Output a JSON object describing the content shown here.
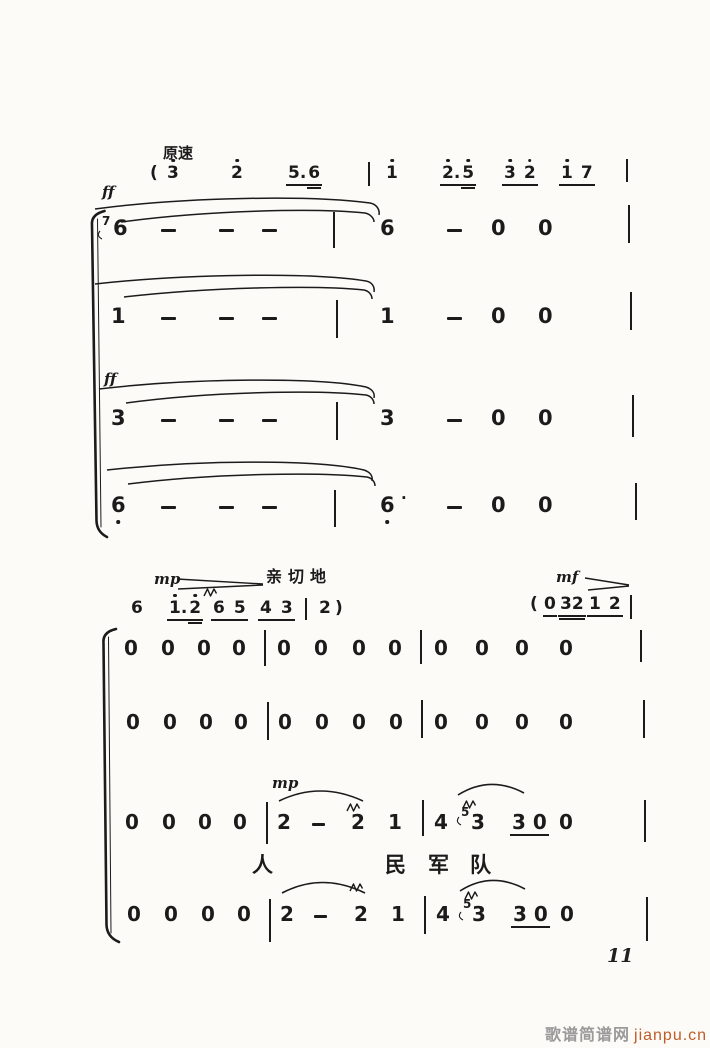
{
  "meta": {
    "ink": "#1b1b1b",
    "paper": "#fcfbf8",
    "accent": "#bf5b28",
    "watermark_gray": "#9a9a9a"
  },
  "page": {
    "number": "11"
  },
  "watermark": {
    "site_name": "歌谱简谱网",
    "site_url": "jianpu.cn"
  },
  "labels": {
    "tempo": "原速",
    "ff_voice1": "ff",
    "ff_voice3": "ff",
    "mp_cue": "mp",
    "expression": "亲切地",
    "mf_cue": "mf",
    "mp_voice": "mp"
  },
  "lines": [
    {
      "name": "cue-line-top",
      "y": 165,
      "fs": 17,
      "tokens": [
        {
          "x": 150,
          "t": "(",
          "cls": "paren",
          "name": "open-paren"
        },
        {
          "x": 167,
          "t": "3",
          "dot": "a",
          "name": "note-3"
        },
        {
          "x": 231,
          "t": "2",
          "dot": "a",
          "name": "note-2"
        },
        {
          "x": 286,
          "type": "grp",
          "gap": 2,
          "parts": [
            {
              "t": "5."
            },
            {
              "t": "6",
              "u2": true
            }
          ],
          "name": "beamed-group-5.6"
        },
        {
          "x": 368,
          "t": "|",
          "type": "bar",
          "h": 24,
          "dy": -3
        },
        {
          "x": 386,
          "t": "1",
          "dot": "a",
          "name": "note-1"
        },
        {
          "x": 440,
          "type": "grp",
          "gap": 2,
          "parts": [
            {
              "t": "2.",
              "dot": "a"
            },
            {
              "t": "5",
              "dot": "a",
              "u2": true
            }
          ],
          "name": "beamed-group-2.5"
        },
        {
          "x": 502,
          "type": "grp",
          "gap": 8,
          "parts": [
            {
              "t": "3",
              "dot": "a"
            },
            {
              "t": "2",
              "dot": "a"
            }
          ],
          "name": "beamed-group-32"
        },
        {
          "x": 559,
          "type": "grp",
          "gap": 8,
          "parts": [
            {
              "t": "1",
              "dot": "a"
            },
            {
              "t": "7"
            }
          ],
          "name": "beamed-group-17"
        },
        {
          "x": 626,
          "t": "|",
          "type": "bar",
          "h": 23,
          "dy": -6
        }
      ]
    },
    {
      "name": "voice-1",
      "y": 218,
      "fs": 21,
      "tokens": [
        {
          "x": 102,
          "t": "7",
          "type": "grace",
          "fs": 12,
          "dy": -3
        },
        {
          "x": 113,
          "t": "6",
          "name": "note-6"
        },
        {
          "x": 161,
          "t": "-",
          "type": "dash"
        },
        {
          "x": 219,
          "t": "-",
          "type": "dash"
        },
        {
          "x": 262,
          "t": "-",
          "type": "dash"
        },
        {
          "x": 333,
          "t": "|",
          "type": "bar",
          "h": 36,
          "dy": -6
        },
        {
          "x": 380,
          "t": "6",
          "name": "note-6"
        },
        {
          "x": 447,
          "t": "-",
          "type": "dash"
        },
        {
          "x": 491,
          "t": "0",
          "name": "rest-0"
        },
        {
          "x": 538,
          "t": "0",
          "name": "rest-0"
        },
        {
          "x": 628,
          "t": "|",
          "type": "bar",
          "h": 38,
          "dy": -13
        }
      ]
    },
    {
      "name": "voice-2",
      "y": 306,
      "fs": 21,
      "tokens": [
        {
          "x": 111,
          "t": "1",
          "name": "note-1"
        },
        {
          "x": 161,
          "t": "-",
          "type": "dash"
        },
        {
          "x": 219,
          "t": "-",
          "type": "dash"
        },
        {
          "x": 262,
          "t": "-",
          "type": "dash"
        },
        {
          "x": 336,
          "t": "|",
          "type": "bar",
          "h": 38,
          "dy": -6
        },
        {
          "x": 380,
          "t": "1",
          "name": "note-1"
        },
        {
          "x": 447,
          "t": "-",
          "type": "dash"
        },
        {
          "x": 491,
          "t": "0",
          "name": "rest-0"
        },
        {
          "x": 538,
          "t": "0",
          "name": "rest-0"
        },
        {
          "x": 630,
          "t": "|",
          "type": "bar",
          "h": 38,
          "dy": -14
        }
      ]
    },
    {
      "name": "voice-3",
      "y": 408,
      "fs": 21,
      "tokens": [
        {
          "x": 111,
          "t": "3",
          "name": "note-3"
        },
        {
          "x": 161,
          "t": "-",
          "type": "dash"
        },
        {
          "x": 219,
          "t": "-",
          "type": "dash"
        },
        {
          "x": 262,
          "t": "-",
          "type": "dash"
        },
        {
          "x": 336,
          "t": "|",
          "type": "bar",
          "h": 38,
          "dy": -6
        },
        {
          "x": 380,
          "t": "3",
          "name": "note-3"
        },
        {
          "x": 447,
          "t": "-",
          "type": "dash"
        },
        {
          "x": 491,
          "t": "0",
          "name": "rest-0"
        },
        {
          "x": 538,
          "t": "0",
          "name": "rest-0"
        },
        {
          "x": 632,
          "t": "|",
          "type": "bar",
          "h": 42,
          "dy": -13
        }
      ]
    },
    {
      "name": "voice-4",
      "y": 495,
      "fs": 21,
      "tokens": [
        {
          "x": 111,
          "t": "6",
          "dot": "b",
          "name": "note-6-low"
        },
        {
          "x": 161,
          "t": "-",
          "type": "dash"
        },
        {
          "x": 219,
          "t": "-",
          "type": "dash"
        },
        {
          "x": 262,
          "t": "-",
          "type": "dash"
        },
        {
          "x": 334,
          "t": "|",
          "type": "bar",
          "h": 37,
          "dy": -5
        },
        {
          "x": 380,
          "t": "6",
          "dot": "b",
          "name": "note-6-low"
        },
        {
          "x": 401,
          "t": "·",
          "fs": 15,
          "dy": -4,
          "name": "ink-speck"
        },
        {
          "x": 447,
          "t": "-",
          "type": "dash"
        },
        {
          "x": 491,
          "t": "0",
          "name": "rest-0"
        },
        {
          "x": 538,
          "t": "0",
          "name": "rest-0"
        },
        {
          "x": 635,
          "t": "|",
          "type": "bar",
          "h": 37,
          "dy": -12
        }
      ]
    },
    {
      "name": "cue-line-mid",
      "y": 600,
      "fs": 17,
      "tokens": [
        {
          "x": 131,
          "t": "6",
          "name": "note-6"
        },
        {
          "x": 167,
          "type": "grp",
          "gap": 2,
          "parts": [
            {
              "t": "1.",
              "dot": "a"
            },
            {
              "t": "2",
              "dot": "a",
              "u2": true
            }
          ],
          "name": "beamed-group-1.2"
        },
        {
          "x": 211,
          "type": "grp",
          "gap": 9,
          "parts": [
            {
              "t": "6"
            },
            {
              "t": "5"
            }
          ],
          "name": "beamed-group-65"
        },
        {
          "x": 258,
          "type": "grp",
          "gap": 9,
          "parts": [
            {
              "t": "4"
            },
            {
              "t": "3"
            }
          ],
          "name": "beamed-group-43"
        },
        {
          "x": 305,
          "t": "|",
          "type": "bar",
          "h": 22,
          "dy": -2
        },
        {
          "x": 319,
          "t": "2",
          "name": "note-2"
        },
        {
          "x": 335,
          "t": ")",
          "cls": "paren",
          "name": "close-paren"
        }
      ]
    },
    {
      "name": "cue-line-mf",
      "y": 596,
      "fs": 17,
      "tokens": [
        {
          "x": 530,
          "t": "(",
          "cls": "paren",
          "name": "open-paren"
        },
        {
          "x": 543,
          "t": "0",
          "u": 1,
          "name": "rest-0"
        },
        {
          "x": 558,
          "type": "grp",
          "gap": 0,
          "parts": [
            {
              "t": "32",
              "u2": true
            }
          ],
          "name": "beamed-group-32"
        },
        {
          "x": 587,
          "type": "grp",
          "gap": 8,
          "parts": [
            {
              "t": "1"
            },
            {
              "t": "2"
            }
          ],
          "name": "beamed-group-12"
        },
        {
          "x": 630,
          "t": "|",
          "type": "bar",
          "h": 24,
          "dy": -1
        }
      ]
    },
    {
      "name": "lower-voice-1",
      "y": 638,
      "fs": 20,
      "tokens": [
        {
          "x": 124,
          "t": "0",
          "name": "rest-0"
        },
        {
          "x": 161,
          "t": "0",
          "name": "rest-0"
        },
        {
          "x": 197,
          "t": "0",
          "name": "rest-0"
        },
        {
          "x": 232,
          "t": "0",
          "name": "rest-0"
        },
        {
          "x": 264,
          "t": "|",
          "type": "bar",
          "h": 36,
          "dy": -8
        },
        {
          "x": 277,
          "t": "0",
          "name": "rest-0"
        },
        {
          "x": 314,
          "t": "0",
          "name": "rest-0"
        },
        {
          "x": 352,
          "t": "0",
          "name": "rest-0"
        },
        {
          "x": 388,
          "t": "0",
          "name": "rest-0"
        },
        {
          "x": 420,
          "t": "|",
          "type": "bar",
          "h": 34,
          "dy": -8
        },
        {
          "x": 434,
          "t": "0",
          "name": "rest-0"
        },
        {
          "x": 475,
          "t": "0",
          "name": "rest-0"
        },
        {
          "x": 515,
          "t": "0",
          "name": "rest-0"
        },
        {
          "x": 559,
          "t": "0",
          "name": "rest-0"
        },
        {
          "x": 640,
          "t": "|",
          "type": "bar",
          "h": 32,
          "dy": -8
        }
      ]
    },
    {
      "name": "lower-voice-2",
      "y": 712,
      "fs": 20,
      "tokens": [
        {
          "x": 126,
          "t": "0",
          "name": "rest-0"
        },
        {
          "x": 163,
          "t": "0",
          "name": "rest-0"
        },
        {
          "x": 199,
          "t": "0",
          "name": "rest-0"
        },
        {
          "x": 234,
          "t": "0",
          "name": "rest-0"
        },
        {
          "x": 267,
          "t": "|",
          "type": "bar",
          "h": 38,
          "dy": -10
        },
        {
          "x": 278,
          "t": "0",
          "name": "rest-0"
        },
        {
          "x": 315,
          "t": "0",
          "name": "rest-0"
        },
        {
          "x": 352,
          "t": "0",
          "name": "rest-0"
        },
        {
          "x": 389,
          "t": "0",
          "name": "rest-0"
        },
        {
          "x": 421,
          "t": "|",
          "type": "bar",
          "h": 38,
          "dy": -12
        },
        {
          "x": 434,
          "t": "0",
          "name": "rest-0"
        },
        {
          "x": 475,
          "t": "0",
          "name": "rest-0"
        },
        {
          "x": 515,
          "t": "0",
          "name": "rest-0"
        },
        {
          "x": 559,
          "t": "0",
          "name": "rest-0"
        },
        {
          "x": 643,
          "t": "|",
          "type": "bar",
          "h": 38,
          "dy": -12
        }
      ]
    },
    {
      "name": "lower-voice-3",
      "y": 812,
      "fs": 20,
      "tokens": [
        {
          "x": 125,
          "t": "0",
          "name": "rest-0"
        },
        {
          "x": 162,
          "t": "0",
          "name": "rest-0"
        },
        {
          "x": 198,
          "t": "0",
          "name": "rest-0"
        },
        {
          "x": 233,
          "t": "0",
          "name": "rest-0"
        },
        {
          "x": 266,
          "t": "|",
          "type": "bar",
          "h": 42,
          "dy": -10
        },
        {
          "x": 277,
          "t": "2",
          "name": "note-2"
        },
        {
          "x": 312,
          "t": "-",
          "type": "dash",
          "w": 13
        },
        {
          "x": 351,
          "t": "2",
          "name": "note-2"
        },
        {
          "x": 388,
          "t": "1",
          "name": "note-1"
        },
        {
          "x": 422,
          "t": "|",
          "type": "bar",
          "h": 36,
          "dy": -12
        },
        {
          "x": 434,
          "t": "4",
          "name": "note-4"
        },
        {
          "x": 461,
          "t": "5",
          "type": "grace",
          "fs": 12,
          "dy": -6
        },
        {
          "x": 471,
          "t": "3",
          "name": "note-3"
        },
        {
          "x": 510,
          "type": "grp",
          "gap": 7,
          "parts": [
            {
              "t": "3"
            },
            {
              "t": "0"
            }
          ],
          "name": "beamed-group-30"
        },
        {
          "x": 559,
          "t": "0",
          "name": "rest-0"
        },
        {
          "x": 644,
          "t": "|",
          "type": "bar",
          "h": 42,
          "dy": -12
        }
      ]
    },
    {
      "name": "lyrics-line",
      "y": 855,
      "fs": 21,
      "cls": "cjk",
      "tokens": [
        {
          "x": 252,
          "t": "人",
          "name": "lyric-char"
        },
        {
          "x": 385,
          "t": "民",
          "name": "lyric-char"
        },
        {
          "x": 428,
          "t": "军",
          "name": "lyric-char"
        },
        {
          "x": 470,
          "t": "队",
          "name": "lyric-char"
        }
      ]
    },
    {
      "name": "lower-voice-4",
      "y": 904,
      "fs": 20,
      "tokens": [
        {
          "x": 127,
          "t": "0",
          "name": "rest-0"
        },
        {
          "x": 164,
          "t": "0",
          "name": "rest-0"
        },
        {
          "x": 201,
          "t": "0",
          "name": "rest-0"
        },
        {
          "x": 237,
          "t": "0",
          "name": "rest-0"
        },
        {
          "x": 269,
          "t": "|",
          "type": "bar",
          "h": 43,
          "dy": -5
        },
        {
          "x": 280,
          "t": "2",
          "name": "note-2"
        },
        {
          "x": 314,
          "t": "-",
          "type": "dash",
          "w": 13
        },
        {
          "x": 354,
          "t": "2",
          "name": "note-2"
        },
        {
          "x": 391,
          "t": "1",
          "name": "note-1"
        },
        {
          "x": 424,
          "t": "|",
          "type": "bar",
          "h": 38,
          "dy": -8
        },
        {
          "x": 436,
          "t": "4",
          "name": "note-4"
        },
        {
          "x": 463,
          "t": "5",
          "type": "grace",
          "fs": 12,
          "dy": -6
        },
        {
          "x": 472,
          "t": "3",
          "name": "note-3"
        },
        {
          "x": 511,
          "type": "grp",
          "gap": 7,
          "parts": [
            {
              "t": "3"
            },
            {
              "t": "0"
            }
          ],
          "name": "beamed-group-30"
        },
        {
          "x": 560,
          "t": "0",
          "name": "rest-0"
        },
        {
          "x": 646,
          "t": "|",
          "type": "bar",
          "h": 44,
          "dy": -7
        }
      ]
    }
  ]
}
